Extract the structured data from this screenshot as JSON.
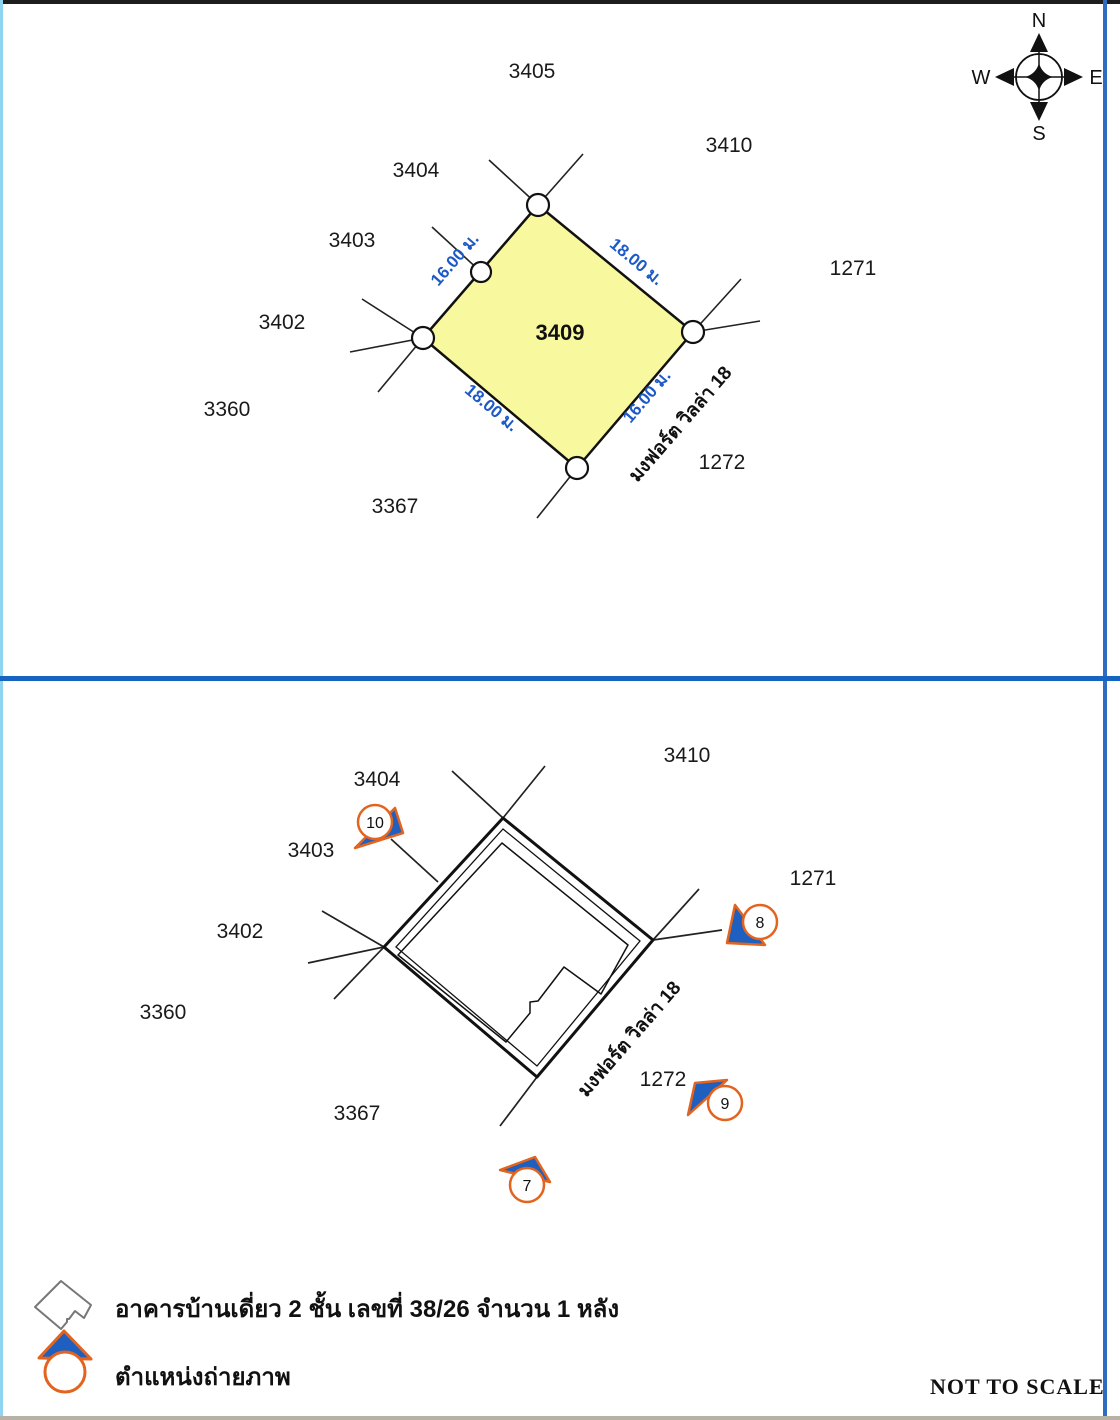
{
  "compass": {
    "n": "N",
    "e": "E",
    "w": "W",
    "s": "S"
  },
  "top_map": {
    "parcel_id": "3409",
    "labels": {
      "l3405": "3405",
      "l3410": "3410",
      "l3404": "3404",
      "l3403": "3403",
      "l1271": "1271",
      "l3402": "3402",
      "l3360": "3360",
      "l1272": "1272",
      "l3367": "3367"
    },
    "dimensions": {
      "nw": "16.00 ม.",
      "ne": "18.00 ม.",
      "sw": "18.00 ม.",
      "se": "16.00 ม."
    },
    "road_name": "มงฟอร์ต วิลล่า 18"
  },
  "bottom_map": {
    "labels": {
      "l3410": "3410",
      "l3404": "3404",
      "l3403": "3403",
      "l1271": "1271",
      "l3402": "3402",
      "l3360": "3360",
      "l1272": "1272",
      "l3367": "3367"
    },
    "road_name": "มงฟอร์ต วิลล่า 18",
    "markers": [
      {
        "id": "10"
      },
      {
        "id": "8"
      },
      {
        "id": "9"
      },
      {
        "id": "7"
      }
    ]
  },
  "legend": {
    "building_label": "อาคารบ้านเดี่ยว 2 ชั้น เลขที่ 38/26 จำนวน 1 หลัง",
    "camera_label": "ตำแหน่งถ่ายภาพ"
  },
  "footer": {
    "scale_note": "NOT TO SCALE"
  },
  "colors": {
    "parcel_fill": "#F8F89E",
    "dimension_blue": "#1D5AC8",
    "divider_blue": "#1565C0",
    "marker_orange": "#E2641E",
    "marker_blue": "#1E5FC0"
  }
}
